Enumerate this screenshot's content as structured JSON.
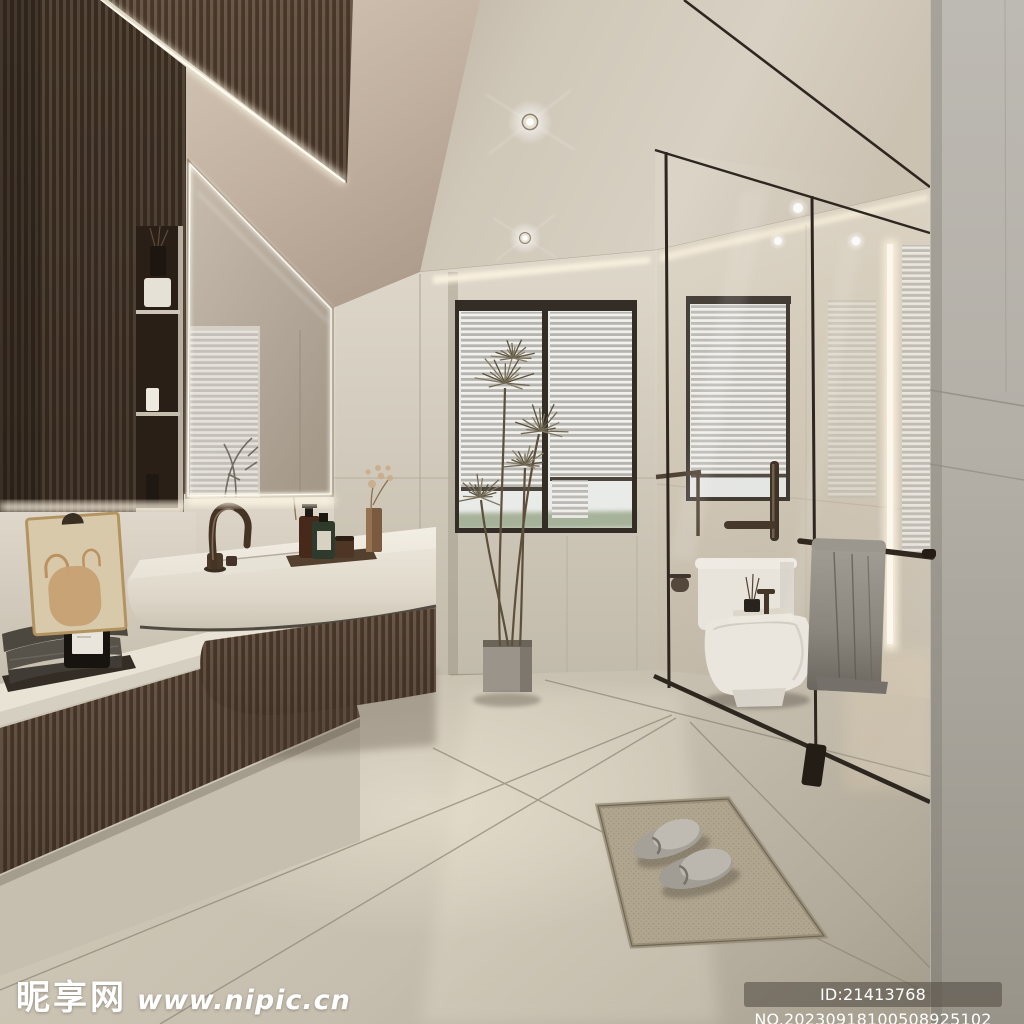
{
  "watermarks": {
    "site_name": "昵享网",
    "site_url": "www.nipic.cn",
    "image_id": "ID:21413768 NO.20230918100508925102"
  },
  "scene": {
    "type": "bathroom-interior-render",
    "description": "Modern minimalist bathroom: dark wood slat wall, LED mirror, floating stone vanity, venetian-blind windows, glass shower with toilet, towel rail, tall dracaena plant, woven mat with slippers",
    "colors": {
      "ceiling": "#cdc4b4",
      "wall_beige": "#d6cfc1",
      "wall_gray": "#b4b0a8",
      "wood_dark": "#4a3a2d",
      "floor": "#c3bbaa",
      "glass_frame": "#2e2923",
      "towel_gray": "#8a867e",
      "led_warm": "#f7eedb",
      "stone_white": "#efeae0"
    }
  }
}
